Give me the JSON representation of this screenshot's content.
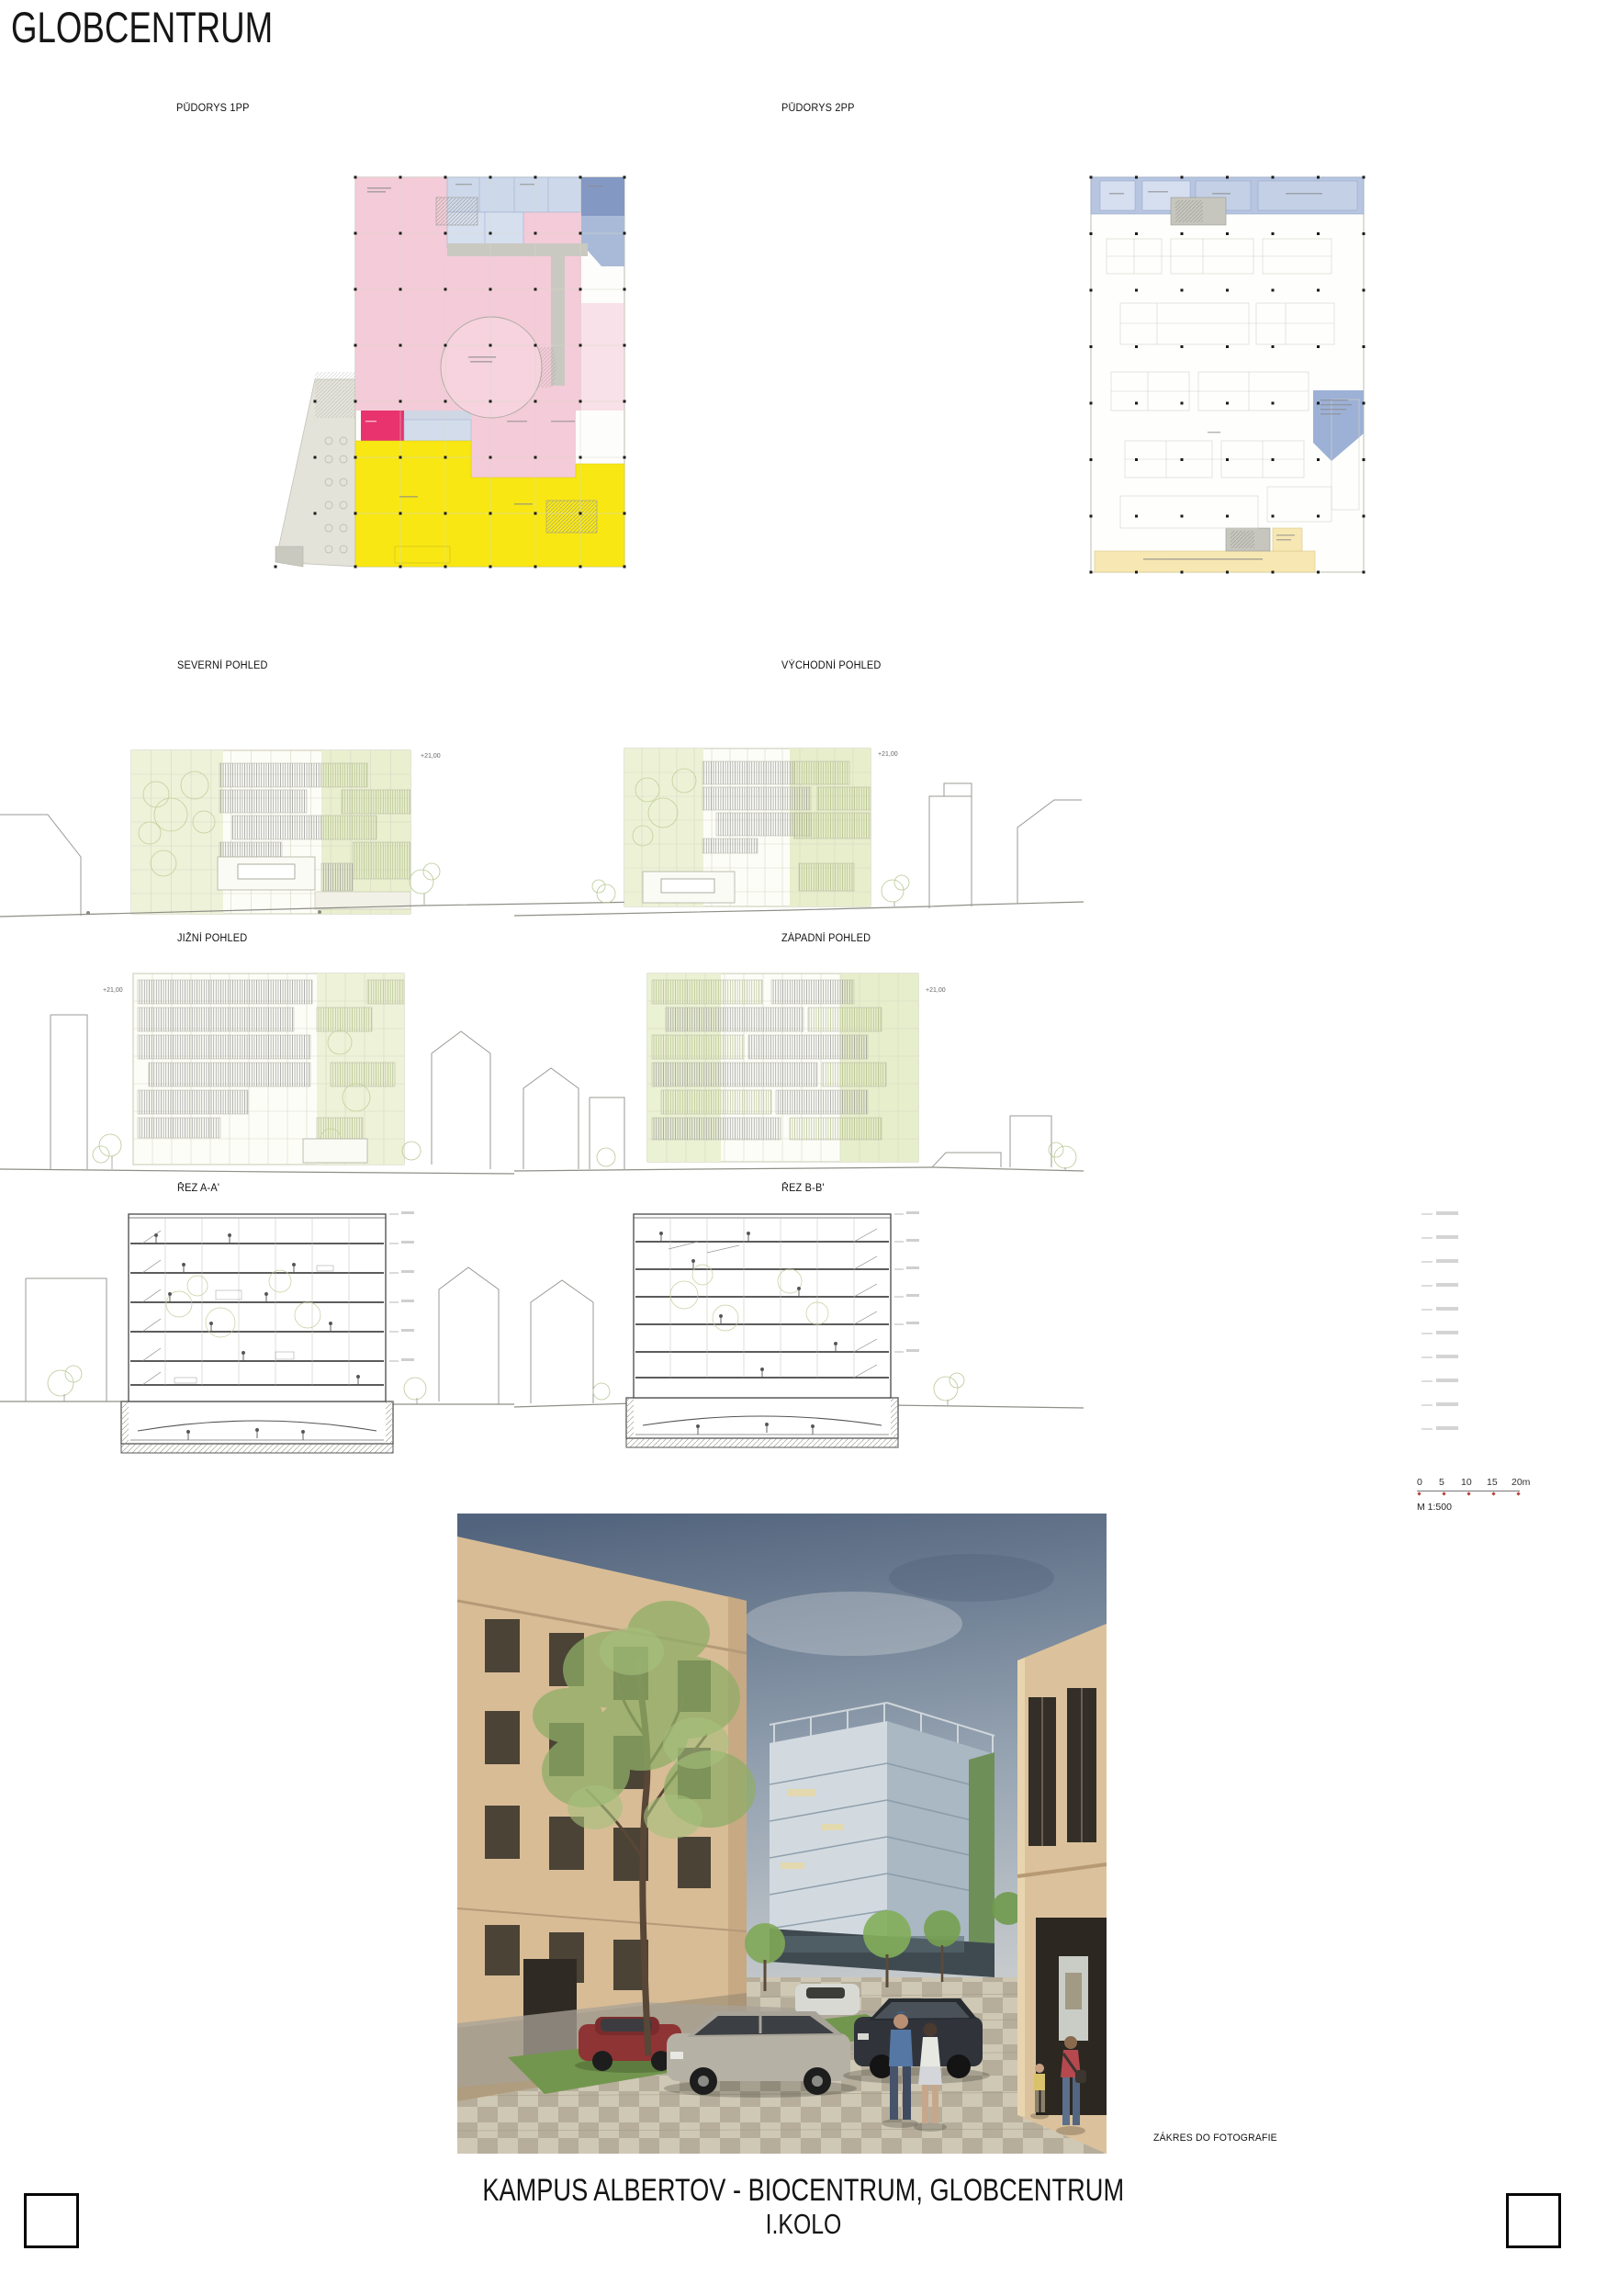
{
  "board": {
    "title": "GLOBCENTRUM",
    "footer_line1": "KAMPUS ALBERTOV - BIOCENTRUM, GLOBCENTRUM",
    "footer_line2": "I.KOLO"
  },
  "drawings": {
    "plan_1pp_label": "PŮDORYS 1PP",
    "plan_2pp_label": "PŮDORYS 2PP",
    "elevation_north_label": "SEVERNÍ POHLED",
    "elevation_east_label": "VÝCHODNÍ POHLED",
    "elevation_south_label": "JIŽNÍ POHLED",
    "elevation_west_label": "ZÁPADNÍ POHLED",
    "section_a_label": "ŘEZ A-A'",
    "section_b_label": "ŘEZ B-B'",
    "photo_caption": "ZÁKRES DO FOTOGRAFIE",
    "level_mark": "+21,00"
  },
  "scalebar": {
    "ticks": [
      "0",
      "5",
      "10",
      "15",
      "20m"
    ],
    "scale_label": "M 1:500",
    "tick_color": "#b4403a"
  },
  "colors": {
    "plan_pink": "#f4cbd8",
    "plan_magenta": "#e8336f",
    "plan_yellow": "#f8e713",
    "plan_blue_light": "#cdd8ea",
    "plan_blue_dark": "#8498c4",
    "plan_cream": "#f7e7b2",
    "terrace_gray": "#e3e3da"
  }
}
